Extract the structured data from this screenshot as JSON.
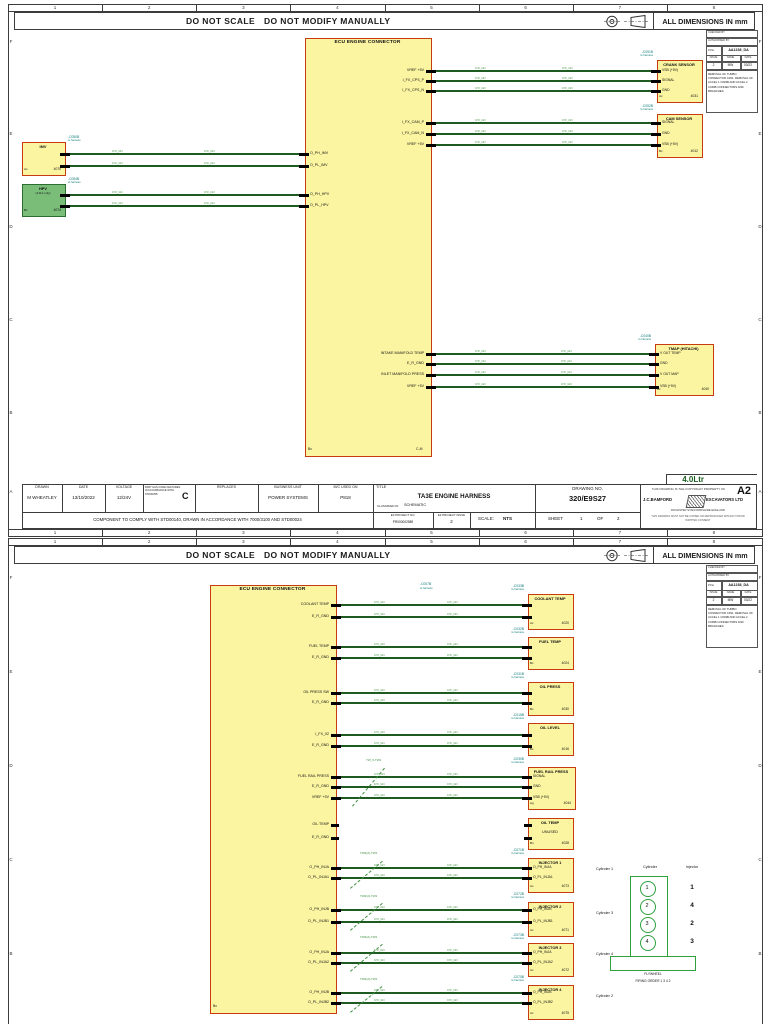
{
  "meta": {
    "do_not_scale": "DO NOT SCALE",
    "do_not_modify": "DO NOT MODIFY MANUALLY",
    "dims": "ALL DIMENSIONS IN mm",
    "ruler": [
      "1",
      "2",
      "3",
      "4",
      "5",
      "6",
      "7",
      "8"
    ],
    "row_letters": [
      "F",
      "E",
      "D",
      "C",
      "B",
      "A"
    ],
    "variant": "4.0Ltr"
  },
  "labels": {
    "to_harness": "to harness",
    "wire": "0.5²_GN"
  },
  "colors": {
    "block_fill": "#FBF5A1",
    "block_border": "#C63B10",
    "green_fill": "#79BD79",
    "green_border": "#2C6E31",
    "wire": "#1D5B21",
    "conn_text": "#0A7878",
    "diagram_green": "#2EA03C",
    "frame": "#3C3C3C"
  },
  "info_panel": {
    "checked": "CHECKED BY",
    "authorised": "AUTHORISED BY",
    "pno_label": "P/No",
    "pno": "AA1238_DA",
    "cols": [
      "ISSUE",
      "NAME",
      "DATE"
    ],
    "vals": [
      "2",
      "MW",
      "03/22"
    ],
    "note": "REMOVAL OF TURBO CONNECTOR C091. REMOVAL OF ACCEL 1 C049B AND ACCEL 2 C049B CONNECTORS AND BRANCHES."
  },
  "title_block": {
    "cells": [
      {
        "h": "DRAWN",
        "v": "M WHEATLEY"
      },
      {
        "h": "DATE",
        "v": "13/10/2022"
      },
      {
        "h": "VOLTAGE",
        "v": "12/24V"
      },
      {
        "h": "PART HAS CODE FEATURES IN ACCORDANCE WITH STD00258",
        "v": "C"
      },
      {
        "h": "REPLACES",
        "v": ""
      },
      {
        "h": "BUSINESS UNIT",
        "v": "POWER SYSTEMS"
      },
      {
        "h": "M/C USED ON",
        "v": "P818"
      }
    ],
    "title_label": "TITLE",
    "title": "TA3E ENGINE HARNESS",
    "classified_label": "CLASSIFIED IN",
    "classified": "SCHEMATIC",
    "drawing_no_label": "DRAWING NO.",
    "drawing_no": "320/E9S27",
    "copyright": "THIS DRAWING IS THE COPYRIGHT PROPERTY OF",
    "company_l": "J.C.BAMFORD",
    "company_r": "EXCAVATORS LTD",
    "address": "ROCESTER   STAFFORDSHIRE   ENGLAND",
    "fine": "THIS DRAWING MUST NOT BE COPIED OR REPRODUCED WITHOUT PRIOR WRITTEN CONSENT",
    "size": "A2",
    "component_note": "COMPONENT TO COMPLY WITH STD00140, DRAWN IN ACCORDANCE WITH 7000/3100 AND STD00024",
    "e3_no_label": "E3 PROJECT NO.",
    "e3_no": "PR000002589",
    "e3_issue_label": "E3 PROJECT ISSUE",
    "e3_issue": "2",
    "scale_label": "SCALE:",
    "scale": "NTS",
    "sheet_words": [
      "SHEET",
      "1",
      "OF",
      "2"
    ]
  },
  "sheet1": {
    "ecu": {
      "title": "ECU ENGINE CONNECTOR",
      "bl": "Bx",
      "br": "C-M",
      "pins_right": [
        {
          "y": 71,
          "label": "VREF +5V"
        },
        {
          "y": 81,
          "label": "I_FX_CPS_P"
        },
        {
          "y": 91,
          "label": "I_FX_CPS_N"
        },
        {
          "y": 123,
          "label": "I_FX_CAM_P"
        },
        {
          "y": 134,
          "label": "I_FX_CAM_N"
        },
        {
          "y": 145,
          "label": "VREF +5V"
        },
        {
          "y": 354,
          "label": "INTAKE MANIFOLD TEMP"
        },
        {
          "y": 364,
          "label": "E_R_GND"
        },
        {
          "y": 375,
          "label": "INLET MANIFOLD PRESS"
        },
        {
          "y": 387,
          "label": "VREF +5V"
        }
      ],
      "pins_left": [
        {
          "y": 154,
          "label": "O_PH_IMV"
        },
        {
          "y": 166,
          "label": "O_PL_IMV"
        },
        {
          "y": 195,
          "label": "O_PH_HPV"
        },
        {
          "y": 206,
          "label": "O_PL_HPV"
        }
      ]
    },
    "blocks": [
      {
        "title": "CRANK SENSOR",
        "conn": "-C051B",
        "code": "4031",
        "des": "Ax",
        "x": 657,
        "y": 60,
        "w": 44,
        "h": 41,
        "fill": "y",
        "side": "left",
        "pins": [
          {
            "y": 71,
            "label": "VSB (+5V)"
          },
          {
            "y": 81,
            "label": "SIGNAL"
          },
          {
            "y": 91,
            "label": "GND"
          }
        ]
      },
      {
        "title": "CAM SENSOR",
        "conn": "-C052B",
        "code": "4012",
        "des": "Bx",
        "x": 657,
        "y": 114,
        "w": 44,
        "h": 42,
        "fill": "y",
        "side": "left",
        "pins": [
          {
            "y": 123,
            "label": "SIGNAL"
          },
          {
            "y": 134,
            "label": "GND"
          },
          {
            "y": 145,
            "label": "VSB (+5V)"
          }
        ]
      },
      {
        "title": "TMAP (HITACHI)",
        "conn": "-C040B",
        "code": "4040",
        "des": "Ax",
        "x": 655,
        "y": 344,
        "w": 57,
        "h": 50,
        "fill": "y",
        "side": "left",
        "pins": [
          {
            "y": 354,
            "label": "V OUT TEMP"
          },
          {
            "y": 364,
            "label": "GND"
          },
          {
            "y": 375,
            "label": "V OUT MAP"
          },
          {
            "y": 387,
            "label": "VSB (+5V)"
          }
        ]
      },
      {
        "title": "IMV",
        "conn": "-C050B",
        "code": "4070",
        "des": "Ax",
        "x": 22,
        "y": 142,
        "w": 42,
        "h": 32,
        "fill": "y",
        "side": "right",
        "pins": [
          {
            "y": 154
          },
          {
            "y": 166
          }
        ]
      },
      {
        "title": "HPV",
        "sub": "(4.0Ltr only)",
        "conn": "-C054B",
        "code": "4074",
        "des": "Bx",
        "x": 22,
        "y": 184,
        "w": 42,
        "h": 31,
        "fill": "g",
        "side": "right",
        "pins": [
          {
            "y": 195
          },
          {
            "y": 206
          }
        ]
      }
    ]
  },
  "sheet2": {
    "ecu": {
      "title": "ECU ENGINE CONNECTOR",
      "bl": "Bx",
      "conn": "-C007B",
      "pins_right": [
        {
          "y": 605,
          "label": "COOLANT TEMP"
        },
        {
          "y": 617,
          "label": "E_R_GND"
        },
        {
          "y": 647,
          "label": "FUEL TEMP"
        },
        {
          "y": 658,
          "label": "E_R_GND"
        },
        {
          "y": 693,
          "label": "OIL PRESS SW"
        },
        {
          "y": 703,
          "label": "E_R_GND"
        },
        {
          "y": 735,
          "label": "I_FX_02"
        },
        {
          "y": 746,
          "label": "E_R_GND"
        },
        {
          "y": 777,
          "label": "FUEL RAIL PRESS"
        },
        {
          "y": 787,
          "label": "E_R_GND"
        },
        {
          "y": 798,
          "label": "VREF +5V"
        },
        {
          "y": 825,
          "label": "OIL TEMP"
        },
        {
          "y": 838,
          "label": "E_R_GND"
        },
        {
          "y": 868,
          "label": "O_PH_INJA"
        },
        {
          "y": 878,
          "label": "O_PL_INJA1"
        },
        {
          "y": 910,
          "label": "O_PH_INJB"
        },
        {
          "y": 922,
          "label": "O_PL_INJB1"
        },
        {
          "y": 953,
          "label": "O_PH_INJA"
        },
        {
          "y": 963,
          "label": "O_PL_INJA2"
        },
        {
          "y": 993,
          "label": "O_PH_INJB"
        },
        {
          "y": 1003,
          "label": "O_PL_INJB2"
        }
      ]
    },
    "blocks": [
      {
        "title": "COOLANT TEMP",
        "conn": "-C033B",
        "code": "4020",
        "des": "Ax",
        "x": 528,
        "y": 594,
        "w": 44,
        "h": 34,
        "fill": "y",
        "side": "left",
        "pins": [
          {
            "y": 605
          },
          {
            "y": 617
          }
        ]
      },
      {
        "title": "FUEL TEMP",
        "conn": "-C032B",
        "code": "4024",
        "des": "Bx",
        "x": 528,
        "y": 637,
        "w": 44,
        "h": 31,
        "fill": "y",
        "side": "left",
        "pins": [
          {
            "y": 647
          },
          {
            "y": 658
          }
        ]
      },
      {
        "title": "OIL PRESS",
        "conn": "-C031B",
        "code": "4030",
        "des": "Bx",
        "x": 528,
        "y": 682,
        "w": 44,
        "h": 32,
        "fill": "y",
        "side": "left",
        "pins": [
          {
            "y": 693
          },
          {
            "y": 703
          }
        ]
      },
      {
        "title": "OIL LEVEL",
        "conn": "-C015B",
        "code": "4016",
        "des": "Bx",
        "x": 528,
        "y": 723,
        "w": 44,
        "h": 31,
        "fill": "y",
        "side": "left",
        "pins": [
          {
            "y": 735
          },
          {
            "y": 746
          }
        ]
      },
      {
        "title": "FUEL RAIL PRESS",
        "conn": "-C030B",
        "code": "4044",
        "des": "Ag",
        "x": 528,
        "y": 767,
        "w": 46,
        "h": 41,
        "fill": "y",
        "side": "left",
        "pins": [
          {
            "y": 777,
            "label": "SIGNAL"
          },
          {
            "y": 787,
            "label": "GND"
          },
          {
            "y": 798,
            "label": "VSB (+5V)"
          }
        ]
      },
      {
        "title": "OIL TEMP",
        "center": "UNUSED",
        "code": "4028",
        "des": "Bn",
        "x": 528,
        "y": 818,
        "w": 44,
        "h": 30,
        "fill": "y",
        "side": "left",
        "no_wires": true,
        "pins": [
          {
            "y": 825
          },
          {
            "y": 838
          }
        ]
      },
      {
        "title": "INJECTOR 1",
        "conn": "-C071B",
        "code": "4073",
        "des": "Ax",
        "x": 528,
        "y": 858,
        "w": 44,
        "h": 33,
        "fill": "y",
        "side": "left",
        "pins": [
          {
            "y": 868,
            "label": "O_PH_INJA"
          },
          {
            "y": 878,
            "label": "O_PL_INJA1"
          }
        ]
      },
      {
        "title": "INJECTOR 2",
        "conn": "-C072B",
        "code": "4071",
        "des": "Ax",
        "x": 528,
        "y": 902,
        "w": 44,
        "h": 33,
        "fill": "y",
        "side": "left",
        "pins": [
          {
            "y": 910,
            "label": "O_PH_INJB"
          },
          {
            "y": 922,
            "label": "O_PL_INJB1"
          }
        ]
      },
      {
        "title": "INJECTOR 3",
        "conn": "-C073B",
        "code": "4072",
        "des": "Ax",
        "x": 528,
        "y": 943,
        "w": 44,
        "h": 32,
        "fill": "y",
        "side": "left",
        "pins": [
          {
            "y": 953,
            "label": "O_PH_INJA"
          },
          {
            "y": 963,
            "label": "O_PL_INJA2"
          }
        ]
      },
      {
        "title": "INJECTOR 4",
        "conn": "-C070B",
        "code": "4075",
        "des": "Ax",
        "x": 528,
        "y": 985,
        "w": 44,
        "h": 33,
        "fill": "y",
        "side": "left",
        "pins": [
          {
            "y": 993,
            "label": "O_PH_INJB"
          },
          {
            "y": 1003,
            "label": "O_PL_INJB2"
          }
        ]
      }
    ],
    "splices": [
      {
        "label": "TW_5-TW1"
      },
      {
        "label": "TW4(2)-TW1"
      },
      {
        "label": "TW4(2)-TW1"
      },
      {
        "label": "TW4(2)-TW1"
      },
      {
        "label": "TW4(2)-TW1"
      }
    ],
    "cylinder_notes": [
      {
        "label": "Cylinder 1"
      },
      {
        "label": "Cylinder 3"
      },
      {
        "label": "Cylinder 4"
      },
      {
        "label": "Cylinder 2"
      }
    ],
    "firing": {
      "col1": "Cylinder",
      "col2": "Injector",
      "cylinders": [
        "1",
        "2",
        "3",
        "4"
      ],
      "injectors": [
        "1",
        "4",
        "2",
        "3"
      ],
      "flywheel": "FLYWHEEL",
      "order": "FIRING ORDER 1 3 4 2"
    }
  }
}
